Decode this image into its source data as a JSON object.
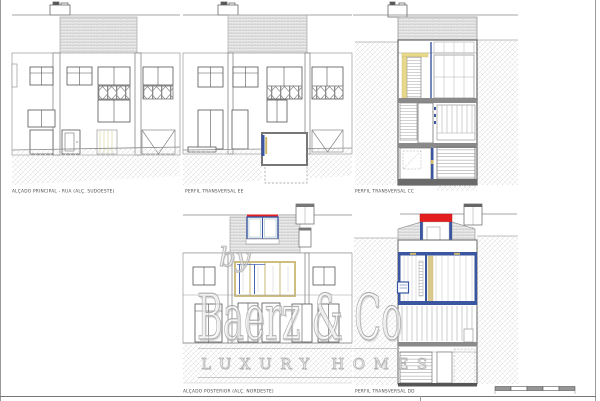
{
  "document": {
    "type": "architectural-elevation-sheet",
    "background": "#ffffff"
  },
  "drawings": [
    {
      "id": "alcado-principal",
      "label": "ALÇADO PRINCIPAL - RUA (ALÇ. SUDOESTE)"
    },
    {
      "id": "perfil-transversal-ee",
      "label": "PERFIL TRANSVERSAL EE"
    },
    {
      "id": "perfil-transversal-cc",
      "label": "PERFIL TRANSVERSAL CC"
    },
    {
      "id": "alcado-posterior",
      "label": "ALÇADO POSTERIOR (ALÇ. NORDESTE)"
    },
    {
      "id": "perfil-transversal-dd",
      "label": "PERFIL TRANSVERSAL DD"
    }
  ],
  "watermark": {
    "prefix": "by",
    "brand": "Baerz & Co",
    "tagline": "LUXURY HOMES"
  },
  "colors": {
    "line_dark": "#555555",
    "line_light": "#999999",
    "roof_fill": "#ebebeb",
    "roof_line": "#bcbcbc",
    "ground_hatch": "#d4d4d4",
    "accent_blue": "#3a56a0",
    "accent_yellow": "#cdb96a",
    "accent_red": "#e31e1e",
    "watermark_gray": "#b9b9b9",
    "slab_gray": "#888888"
  },
  "scale_bar": {
    "segments": 5,
    "fill": "#969696"
  }
}
